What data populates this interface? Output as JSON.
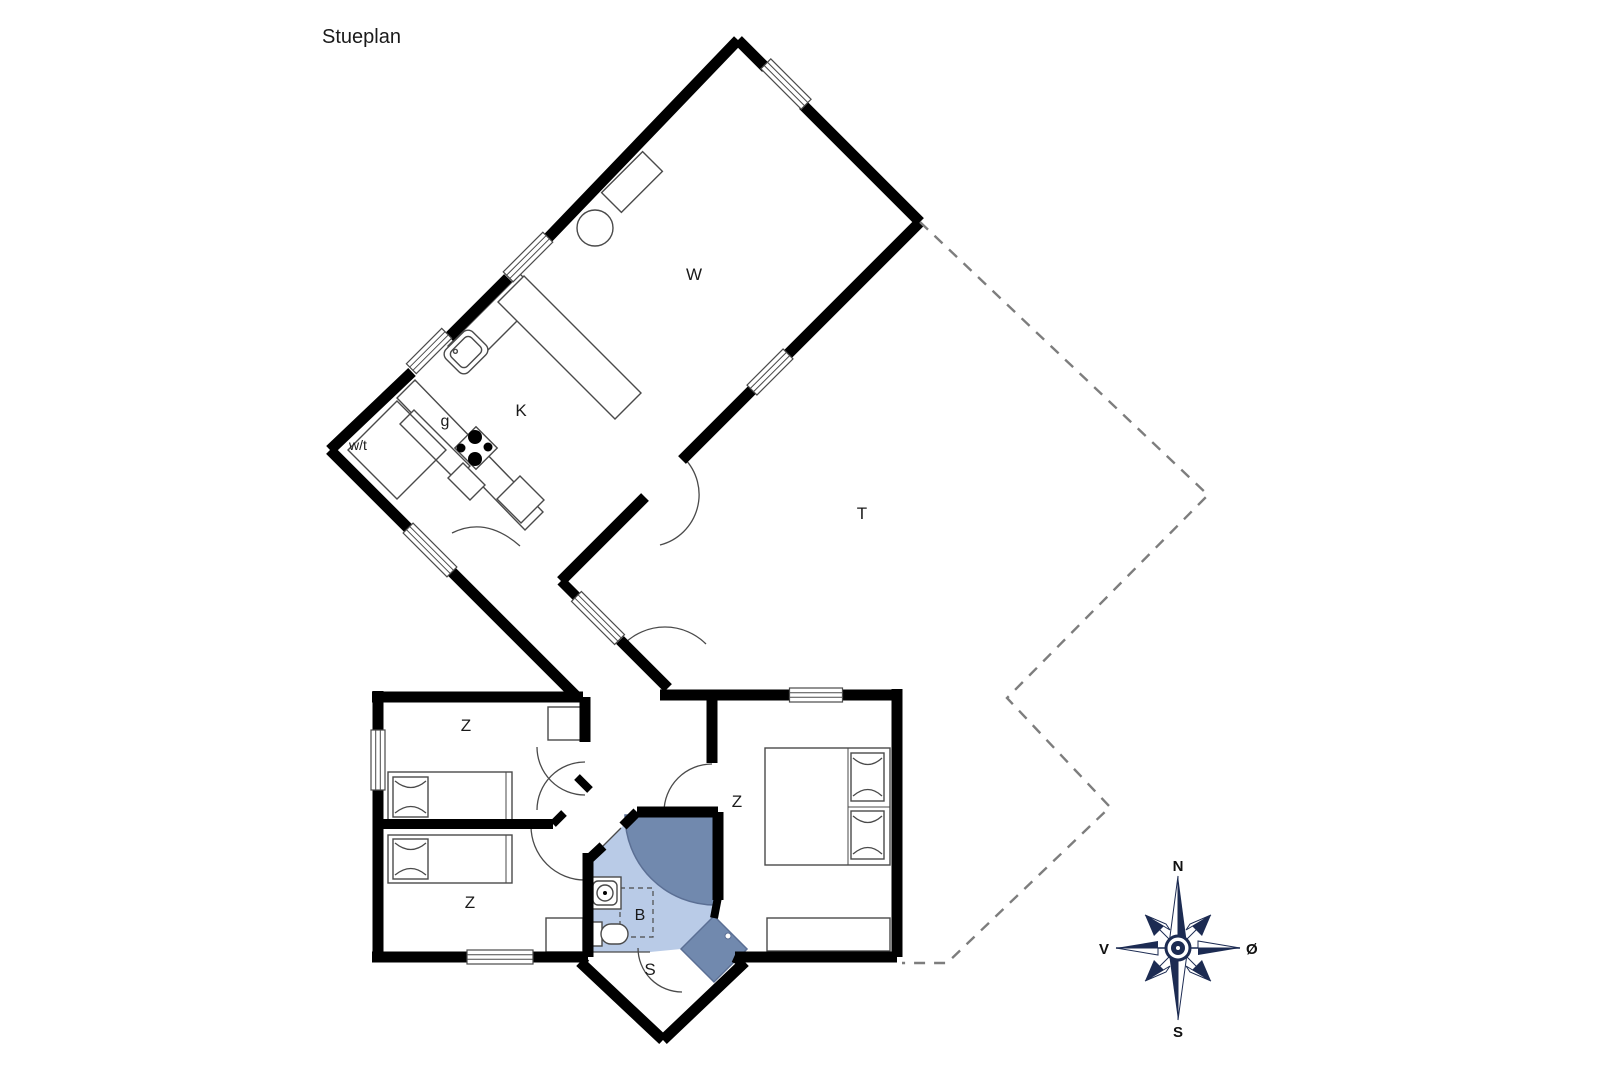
{
  "title": "Stueplan",
  "rooms": {
    "living": "W",
    "kitchen": "K",
    "pantry": "g",
    "utility": "w/t",
    "terrace": "T",
    "bedroom_top_left": "Z",
    "bedroom_bottom_left": "Z",
    "bedroom_right": "Z",
    "bathroom": "B",
    "entry": "S"
  },
  "compass": {
    "north": "N",
    "south": "S",
    "west": "V",
    "east": "Ø"
  },
  "colors": {
    "wall": "#000000",
    "furniture_line": "#4a4a4a",
    "bathroom_fill": "#b9cbe7",
    "shower_fill": "#7189ae",
    "shower_stroke": "#5b6f94",
    "dash_line": "#7d7d7d",
    "compass_navy": "#1c2b52",
    "text": "#1a1a1a",
    "background": "#ffffff"
  }
}
